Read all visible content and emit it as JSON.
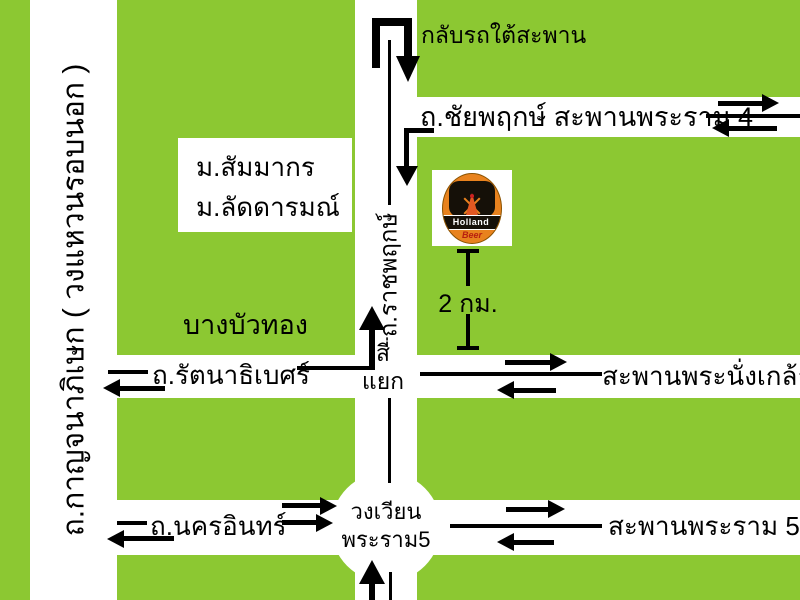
{
  "map": {
    "colors": {
      "background": "#8CC832",
      "road": "#FFFFFF",
      "line": "#000000"
    },
    "notes": {
      "u_turn": "กลับรถใต้สะพาน"
    },
    "roads": {
      "outer_ring": "ถ.กาญจนาภิเษก ( วงแหวนรอบนอก )",
      "ratchaphruek": "ถ.ราชพฤกษ์",
      "chaiyaphruek_rama4": "ถ.ชัยพฤกษ์ สะพานพระราม 4",
      "rattanathibet": "ถ.รัตนาธิเบศร์",
      "phra_nangklao_bridge": "สะพานพระนั่งเกล้า",
      "nakhon_in": "ถ.นครอินทร์",
      "rama5_bridge": "สะพานพระราม 5"
    },
    "places": {
      "village_line1": "ม.สัมมากร",
      "village_line2": "ม.ลัดดารมณ์",
      "bang_bua_thong": "บางบัวทอง",
      "intersection_line1": "สี่",
      "intersection_line2": "แยก",
      "roundabout_line1": "วงเวียน",
      "roundabout_line2": "พระราม5",
      "distance": "2 กม."
    },
    "logo": {
      "line1": "Holland",
      "line2": "Beer"
    }
  }
}
